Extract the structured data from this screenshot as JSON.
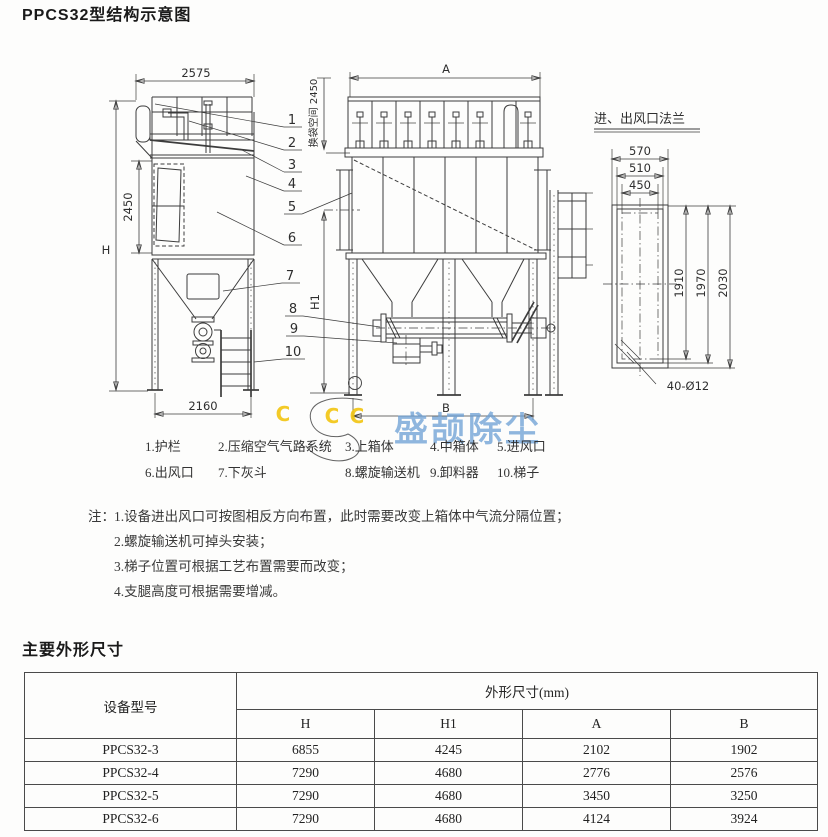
{
  "page": {
    "title": "PPCS32型结构示意图",
    "section2_title": "主要外形尺寸"
  },
  "diagram": {
    "side_view": {
      "dim_top_width": "2575",
      "dim_height": "H",
      "dim_body_height": "2450",
      "dim_base_width": "2160"
    },
    "front_view": {
      "dim_top_width": "A",
      "dim_bag_space": "换袋空间 2450",
      "dim_h1": "H1",
      "dim_base_width": "B"
    },
    "flange_view": {
      "title": "进、出风口法兰",
      "dim_widths": [
        "570",
        "510",
        "450"
      ],
      "dim_heights": [
        "1910",
        "1970",
        "2030"
      ],
      "dim_bolt_holes": "40-Ø12"
    },
    "callouts": [
      "1",
      "2",
      "3",
      "4",
      "5",
      "6",
      "7",
      "8",
      "9",
      "10"
    ]
  },
  "watermark": {
    "letter": "C",
    "text": "盛颉除尘"
  },
  "legend": {
    "items": [
      "1.护栏",
      "2.压缩空气气路系统",
      "3.上箱体",
      "4.中箱体",
      "5.进风口",
      "6.出风口",
      "7.下灰斗",
      "8.螺旋输送机",
      "9.卸料器",
      "10.梯子"
    ]
  },
  "notes": {
    "prefix": "注：",
    "items": [
      "1.设备进出风口可按图相反方向布置，此时需要改变上箱体中气流分隔位置；",
      "2.螺旋输送机可掉头安装；",
      "3.梯子位置可根据工艺布置需要而改变；",
      "4.支腿高度可根据需要增减。"
    ]
  },
  "table": {
    "model_header": "设备型号",
    "group_header": "外形尺寸(mm)",
    "sub_headers": [
      "H",
      "H1",
      "A",
      "B"
    ],
    "rows": [
      [
        "PPCS32-3",
        "6855",
        "4245",
        "2102",
        "1902"
      ],
      [
        "PPCS32-4",
        "7290",
        "4680",
        "2776",
        "2576"
      ],
      [
        "PPCS32-5",
        "7290",
        "4680",
        "3450",
        "3250"
      ],
      [
        "PPCS32-6",
        "7290",
        "4680",
        "4124",
        "3924"
      ]
    ]
  }
}
